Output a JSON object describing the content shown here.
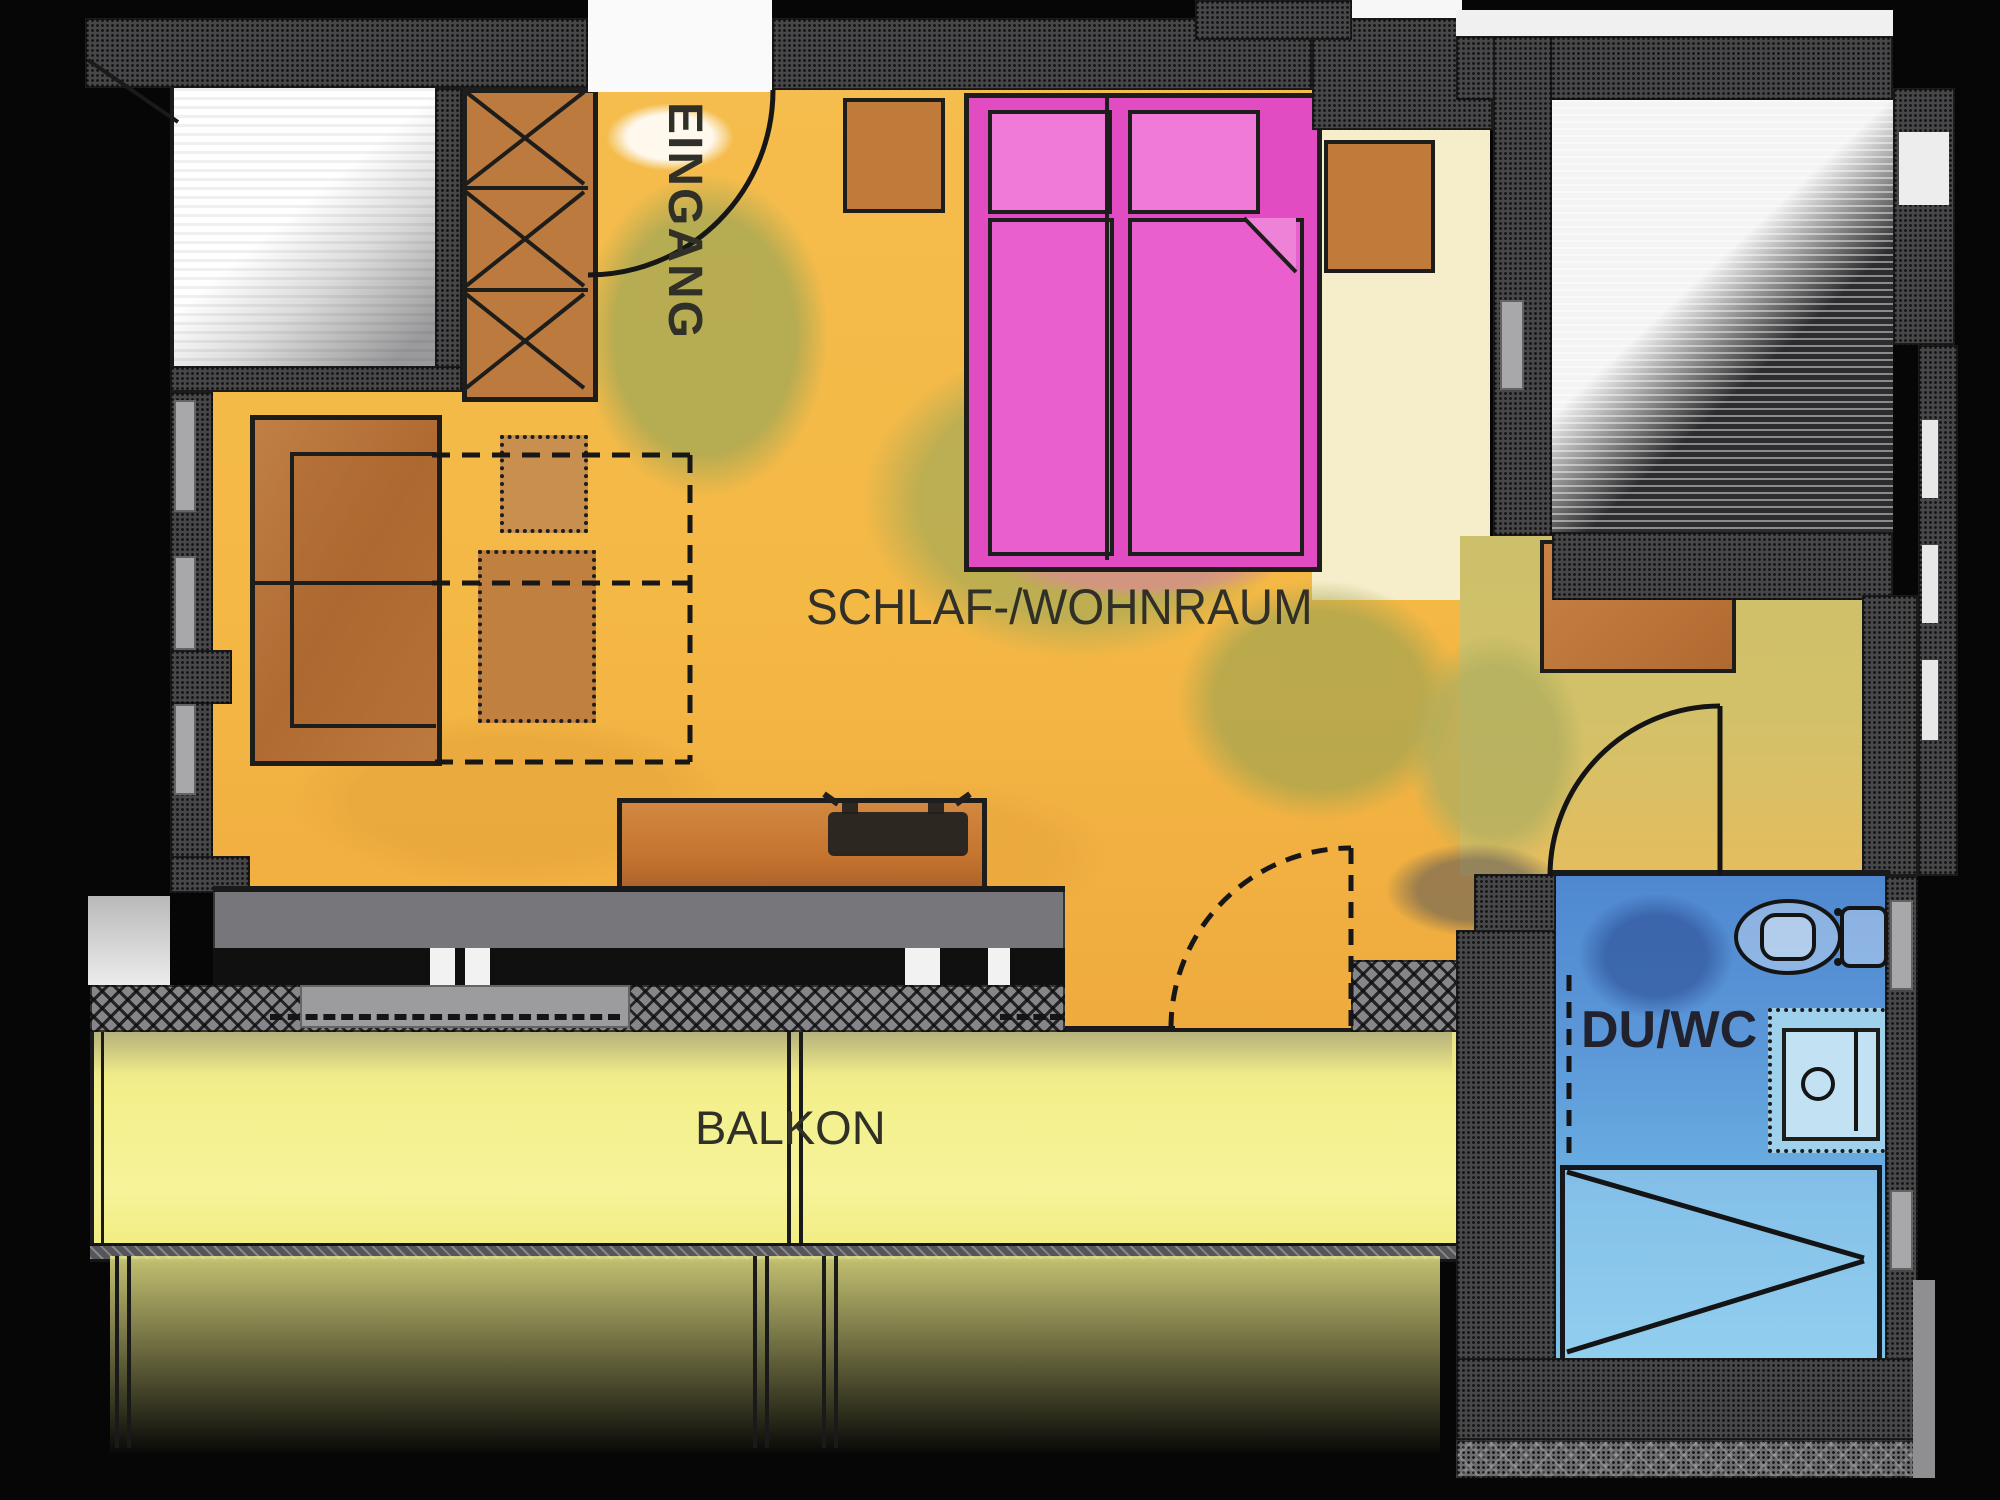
{
  "drawing": {
    "type": "hand-drawn watercolor apartment floor plan",
    "width_px": 2000,
    "height_px": 1500,
    "background": "#060606"
  },
  "rooms": {
    "entrance": {
      "label": "EINGANG",
      "floor_color": "#f4b845"
    },
    "living": {
      "label": "SCHLAF-/WOHNRAUM",
      "floor_color": "#f4b845",
      "wash_color": "#a7a854"
    },
    "balcony": {
      "label": "BALKON",
      "floor_color": "#f3f08c"
    },
    "bath": {
      "label": "DU/WC",
      "floor_color": "#5590d6"
    }
  },
  "furniture_icons": [
    "wardrobe",
    "sofa-bed",
    "pullout-bed-dashed",
    "coffee-table",
    "side-table",
    "tv-sideboard",
    "tv",
    "double-bed",
    "pillow",
    "nightstand",
    "bench",
    "toilet",
    "washbasin",
    "shower"
  ],
  "door_icons": [
    "entrance-door-swing",
    "bathroom-door-swing",
    "balcony-door-swing-dashed"
  ],
  "palette": {
    "walls": "#47474a",
    "sill_hatch": "#85858a",
    "furniture_wood": "#bd7a3e",
    "bed_magenta": "#e64ac6",
    "pillow_pink": "#f07ad8",
    "bath_blue": "#5590d6",
    "shower_blue": "#7fc6ec",
    "ink": "#1b1b1b",
    "label_color": "#303028"
  }
}
